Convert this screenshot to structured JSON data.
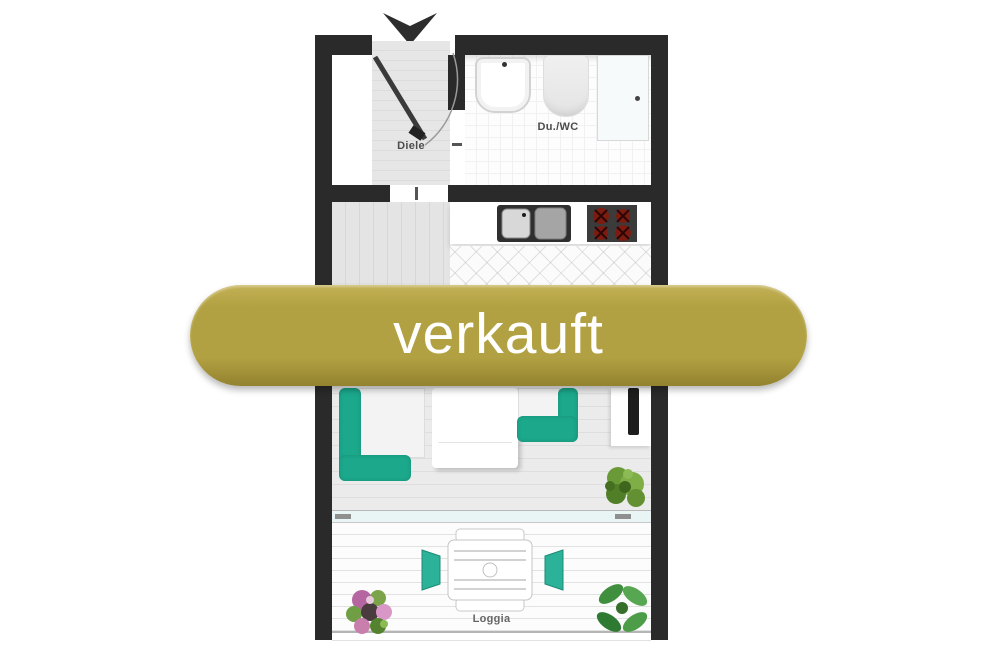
{
  "banner": {
    "label": "verkauft"
  },
  "rooms": {
    "diele": {
      "label": "Diele"
    },
    "bath": {
      "label": "Du./WC"
    },
    "loggia": {
      "label": "Loggia"
    }
  },
  "colors": {
    "wall": "#2a2a2a",
    "banner_bg": "#b2a142",
    "banner_bg_light": "#c3b156",
    "banner_bg_dark": "#93822f",
    "banner_text": "#ffffff",
    "sofa_teal": "#1ba88b",
    "chair_teal": "#2cb299",
    "burner_red": "#7e1b10",
    "plant_green": "#5d9133"
  },
  "objects": [
    "entrance-arrow",
    "entry-door-swing",
    "wash-basin",
    "toilet",
    "shower",
    "kitchen-sink",
    "cooktop",
    "corner-sofa",
    "bed",
    "armchair",
    "tv",
    "potted-plant",
    "loggia-table",
    "loggia-chairs",
    "flower-pot",
    "loggia-plant"
  ]
}
